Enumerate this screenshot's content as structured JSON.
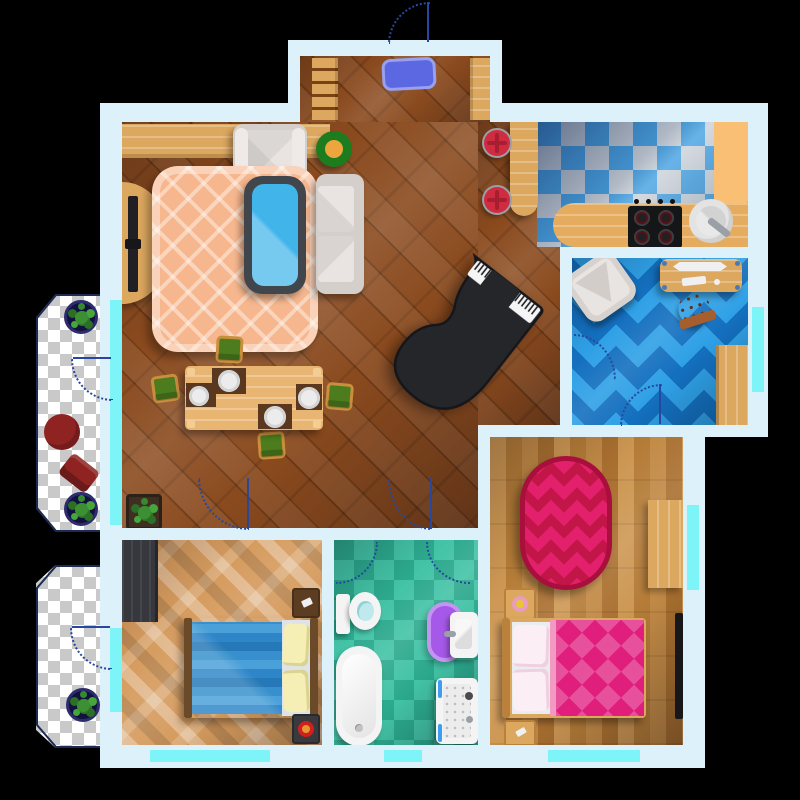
{
  "scene": {
    "title": "apartment-floor-plan-top-view",
    "canvas": {
      "width": 800,
      "height": 800
    },
    "background": "#000000",
    "window_count": 7,
    "door_arc_count": 9
  },
  "colors": {
    "bg": "#000000",
    "wall": "#ddf1fb",
    "window": "#7df4f7",
    "doorArc": "#27489e",
    "livingFloor": "#8a4a1e",
    "furnWood": "#dca75f",
    "entryMat": "#5c68e2",
    "entryMatBorder": "#98a0ef",
    "rugOrange": "#f6b78e",
    "rugOrangeLine": "#fbd9bf",
    "sofaFrame": "#d5cfcb",
    "sofaCushion": "#e9e4e1",
    "coffeeGlass": "#41b4e9",
    "coffeeFrame": "#41464c",
    "plantRing": "#1d7c1d",
    "plantCenter": "#eda63e",
    "tvBlack": "#202024",
    "chairGreen": "#4c7c1d",
    "chairFrame": "#c98f3d",
    "placemat": "#5a381f",
    "plate": "#ececec",
    "piano": "#24262a",
    "stoolRed": "#d12b41",
    "kitchenCheckA": "#4ba4e2",
    "kitchenCheckB": "#ccd3d9",
    "counter": "#e5ac60",
    "counterLight": "#f8bf75",
    "stove": "#151618",
    "sink": "#e3e3e3",
    "chevronDark": "#1470bf",
    "chevronLight": "#2fa0e6",
    "deskChairBrown": "#8a4b26",
    "bedroomRightFloor": "#c08a45",
    "rugRed": "#c21649",
    "rugRedBorder": "#a80f3c",
    "rugRedZig": "#e3206b",
    "bedPink": "#e01f7d",
    "pillowPink": "#fbeff5",
    "bathCheckA": "#43c3a6",
    "bathCheckB": "#2ca98d",
    "fixtureWhite": "#f4f4f4",
    "rugPurple": "#a659e8",
    "rugPurpleBorder": "#c494f2",
    "bedroomLeftFloor": "#d59b5e",
    "wardrobeDark": "#36383d",
    "bedBlue": "#2e86c8",
    "pillowYellow": "#f6efb5",
    "balconyCheckA": "#ffffff",
    "balconyCheckB": "#c9c9c9",
    "balconyRed": "#8e2322",
    "potNavy": "#2c2c6e"
  },
  "rooms": [
    {
      "id": "entrance-hall",
      "floor": "wood-diagonal",
      "furniture": [
        "door-mat",
        "coat-rack",
        "shoe-shelf"
      ]
    },
    {
      "id": "living-room",
      "floor": "wood-diagonal",
      "furniture": [
        "wall-shelf",
        "armchair",
        "potted-plant",
        "plaid-rug",
        "coffee-table",
        "sofa",
        "tv-stand",
        "tv",
        "dining-table",
        "dining-chairs-x4",
        "plates-x4",
        "grand-piano",
        "piano-bench",
        "floor-plant",
        "bar-counter",
        "bar-stools-x2"
      ]
    },
    {
      "id": "kitchen",
      "floor": "blue-checker",
      "furniture": [
        "counter",
        "stove",
        "sink"
      ]
    },
    {
      "id": "office",
      "floor": "blue-chevron",
      "furniture": [
        "armchair",
        "desk",
        "monitor",
        "keyboard",
        "desk-chair",
        "closet"
      ]
    },
    {
      "id": "bedroom-large",
      "floor": "wood-planks",
      "furniture": [
        "oval-rug",
        "dresser",
        "wall-tv",
        "nightstand-with-lamp",
        "double-bed",
        "nightstand-with-phone"
      ]
    },
    {
      "id": "bathroom",
      "floor": "teal-checker",
      "furniture": [
        "toilet",
        "purple-rug",
        "sink",
        "bathtub",
        "shower"
      ]
    },
    {
      "id": "bedroom-small",
      "floor": "herringbone-parquet",
      "furniture": [
        "wardrobe",
        "bed",
        "nightstand-with-phone",
        "nightstand-with-lamp"
      ]
    },
    {
      "id": "balcony-large",
      "floor": "transparent-checker",
      "furniture": [
        "potted-plant-top",
        "potted-plant-bottom",
        "round-table",
        "chair"
      ]
    },
    {
      "id": "balcony-small",
      "floor": "transparent-checker",
      "furniture": [
        "potted-plant"
      ]
    }
  ]
}
